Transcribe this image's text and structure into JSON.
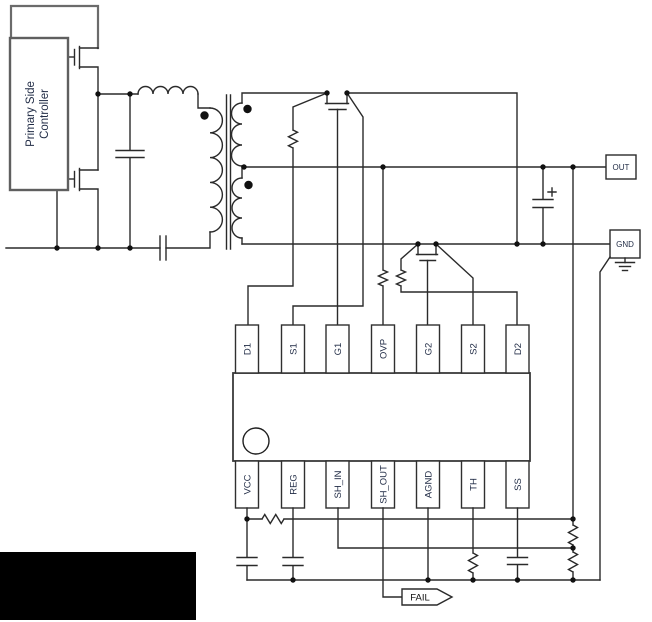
{
  "controller": {
    "line1": "Primary Side",
    "line2": "Controller"
  },
  "ic": {
    "top_pins": [
      "D1",
      "S1",
      "G1",
      "OVP",
      "G2",
      "S2",
      "D2"
    ],
    "bottom_pins": [
      "VCC",
      "REG",
      "SH_IN",
      "SH_OUT",
      "AGND",
      "TH",
      "SS"
    ]
  },
  "terminals": {
    "out": "OUT",
    "gnd": "GND"
  },
  "signals": {
    "fail": "FAIL"
  },
  "components": {
    "transformer": "center-tapped-transformer",
    "sync_rectifiers": [
      "sr1-mosfet",
      "sr2-mosfet"
    ],
    "primary_switches": [
      "high-side-mosfet",
      "low-side-mosfet"
    ]
  },
  "colors": {
    "wire": "#2a2a2a",
    "label_text": "#1f2a44",
    "redaction": "#000000",
    "background": "#ffffff"
  }
}
